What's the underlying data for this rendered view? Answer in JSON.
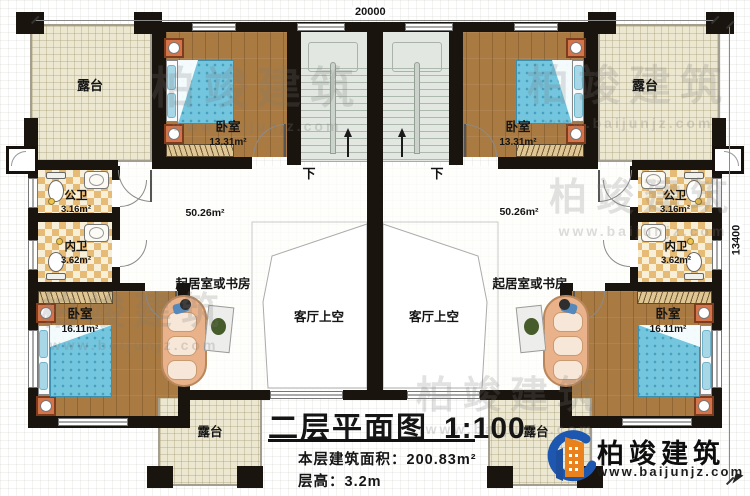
{
  "dimensions": {
    "top": "20000",
    "right": "13400"
  },
  "labels": {
    "terrace": "露台",
    "bedroom": "卧室",
    "bedroom_area_small": "13.31m²",
    "bedroom_area_large": "16.11m²",
    "public_bath": "公卫",
    "public_bath_area": "3.16m²",
    "private_bath": "内卫",
    "private_bath_area": "3.62m²",
    "hall_area": "50.26m²",
    "stairs_down": "下",
    "living_or_study": "起居室或书房",
    "living_void": "客厅上空"
  },
  "titleblock": {
    "title": "二层平面图",
    "scale": "1:100",
    "area_label": "本层建筑面积：",
    "area_value": "200.83m²",
    "height_label": "层高：",
    "height_value": "3.2m"
  },
  "brand": {
    "name": "柏竣建筑",
    "url": "www.baijunjz.com"
  },
  "watermark": {
    "name": "柏竣建筑",
    "url": "www.baijunjz.com"
  },
  "colors": {
    "wall": "#1a140e",
    "wood_floor": "#a97a41",
    "terrace_floor": "#ece7d1",
    "tile_dark": "#e6bb76",
    "tile_light": "#f8efd8",
    "stair_floor": "#e2e7e1",
    "bed_blue": "#74c5de",
    "nightstand_orange": "#d4744a",
    "sofa_salmon": "#eab28a",
    "logo_blue": "#1d57b0",
    "logo_orange": "#e9821c"
  }
}
